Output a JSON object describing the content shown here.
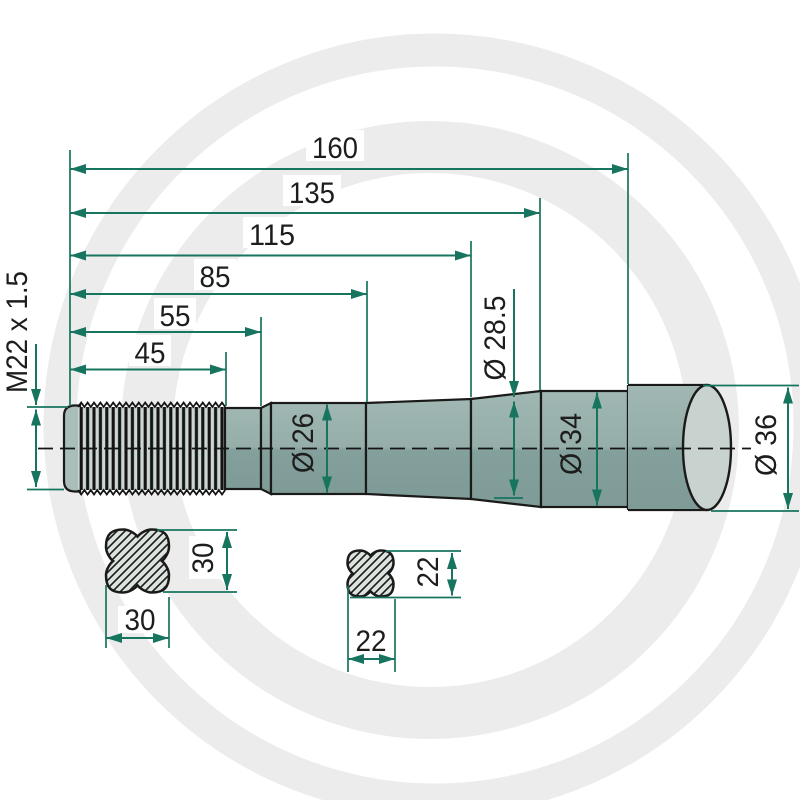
{
  "drawing": {
    "title": "tine-technical-drawing",
    "length_dims": {
      "d160": "160",
      "d135": "135",
      "d115": "115",
      "d85": "85",
      "d55": "55",
      "d45": "45"
    },
    "thread": {
      "label": "M22 x 1.5"
    },
    "diameters": {
      "d26": "Ø 26",
      "d285": "Ø 28.5",
      "d34": "Ø 34",
      "d36": "Ø 36"
    },
    "cross_section_large": {
      "width": "30",
      "height": "30"
    },
    "cross_section_small": {
      "width": "22",
      "height": "22"
    },
    "colors": {
      "dimension_green": "#17745f",
      "outline_black": "#1a1a19",
      "body_light": "#9fb6b2",
      "body_dark": "#7f9b97",
      "end_face": "#c8d3d0",
      "thread_light": "#cbd7d3",
      "cross_fill": "#dce3df",
      "watermark_gray": "#ececec"
    }
  }
}
